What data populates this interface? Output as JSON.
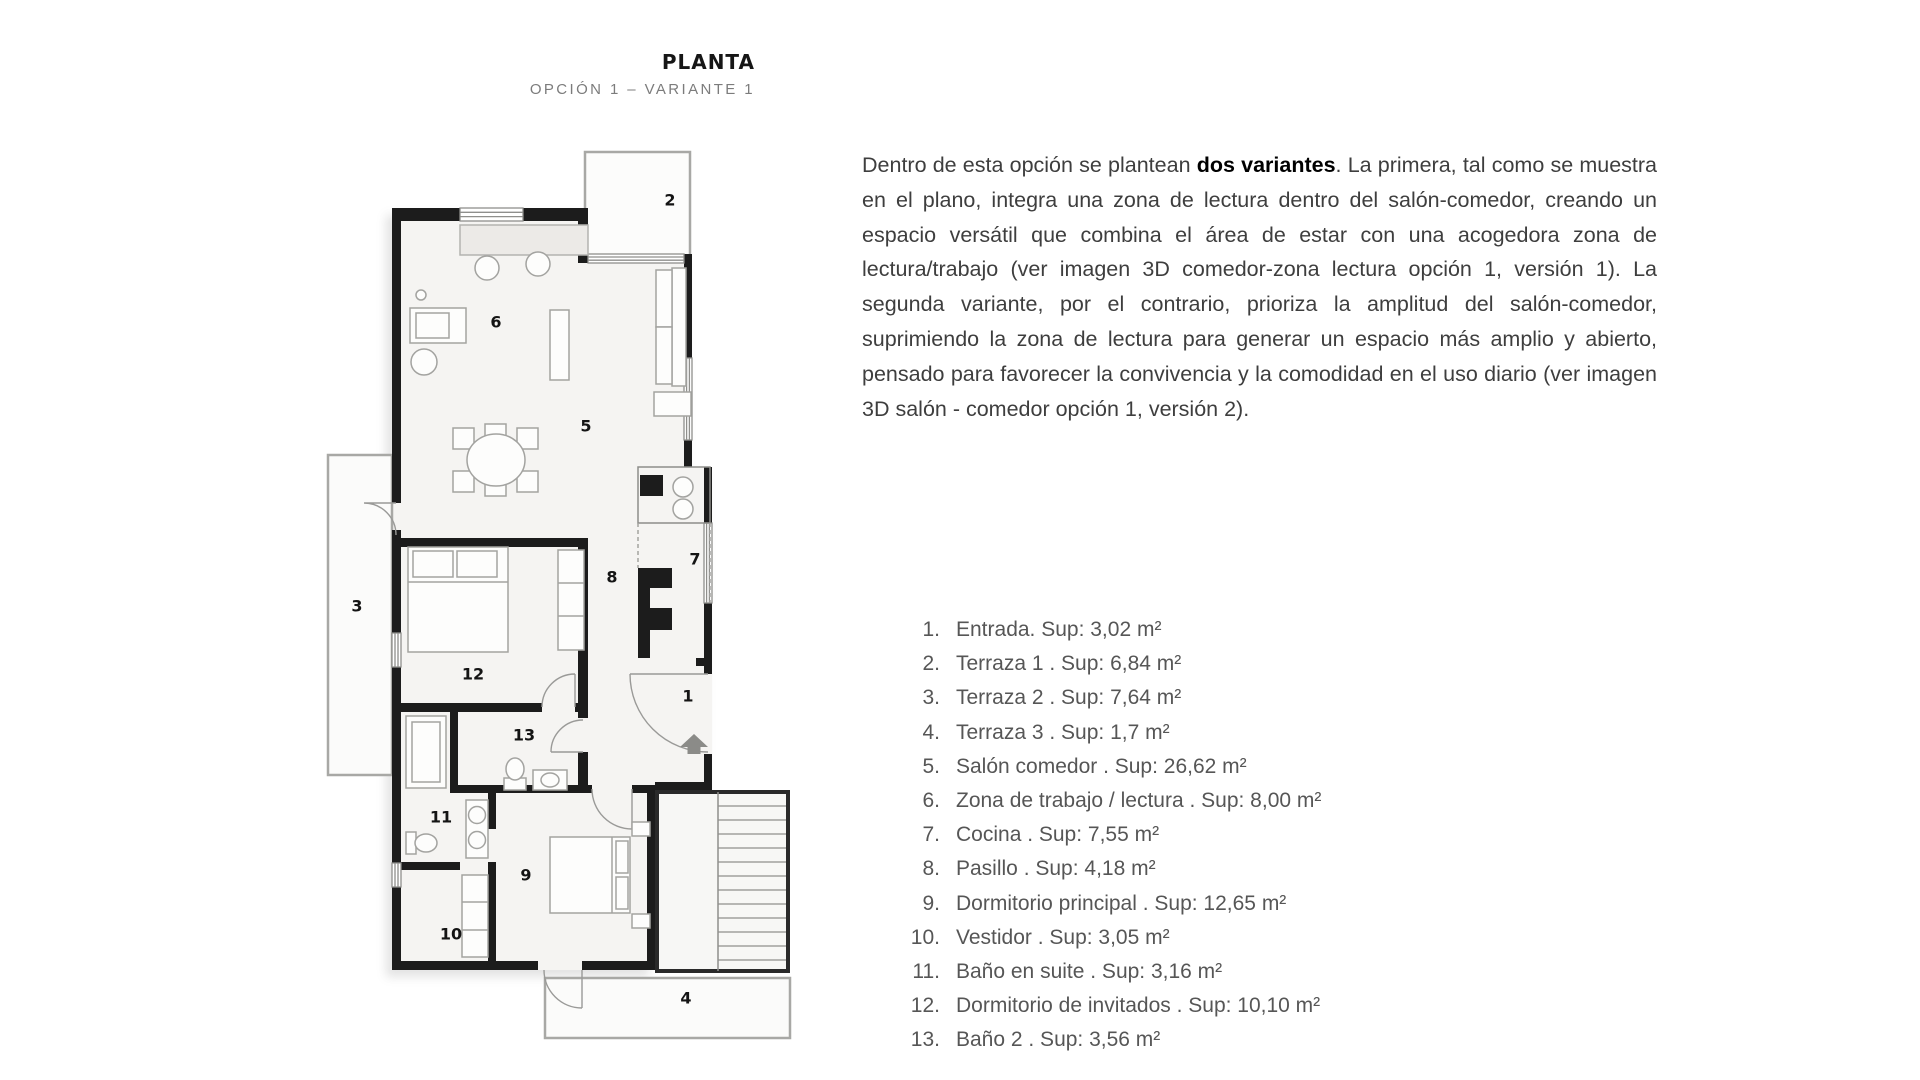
{
  "header": {
    "title": "PLANTA",
    "subtitle": "OPCIÓN 1 – VARIANTE 1"
  },
  "description": {
    "before_bold": "Dentro de esta opción se plantean ",
    "bold": "dos variantes",
    "after_bold": ". La primera, tal como se muestra en el plano, integra una zona de lectura dentro del salón-comedor, creando un espacio versátil que combina el área de estar con una acogedora zona de lectura/trabajo (ver imagen 3D comedor-zona lectura opción 1, versión 1). La segunda variante, por el contrario, prioriza la amplitud del salón-comedor, suprimiendo la zona de lectura para generar un espacio más amplio y abierto, pensado para favorecer la convivencia y la comodidad en el uso diario (ver imagen 3D salón - comedor opción 1, versión 2)."
  },
  "rooms": [
    {
      "num": "1.",
      "text": "Entrada. Sup: 3,02 m²"
    },
    {
      "num": "2.",
      "text": "Terraza 1 . Sup: 6,84 m²"
    },
    {
      "num": "3.",
      "text": "Terraza 2 . Sup: 7,64 m²"
    },
    {
      "num": "4.",
      "text": "Terraza 3 . Sup: 1,7 m²"
    },
    {
      "num": "5.",
      "text": "Salón comedor . Sup: 26,62 m²"
    },
    {
      "num": "6.",
      "text": "Zona de trabajo / lectura . Sup: 8,00 m²"
    },
    {
      "num": "7.",
      "text": "Cocina . Sup: 7,55 m²"
    },
    {
      "num": "8.",
      "text": "Pasillo . Sup: 4,18 m²"
    },
    {
      "num": "9.",
      "text": "Dormitorio principal . Sup: 12,65 m²"
    },
    {
      "num": "10.",
      "text": "Vestidor . Sup: 3,05 m²"
    },
    {
      "num": "11.",
      "text": "Baño en suite . Sup: 3,16 m²"
    },
    {
      "num": "12.",
      "text": "Dormitorio de invitados . Sup: 10,10 m²"
    },
    {
      "num": "13.",
      "text": "Baño 2 . Sup: 3,56 m²"
    }
  ],
  "plan": {
    "labels": [
      {
        "n": "1",
        "x": 368,
        "y": 556
      },
      {
        "n": "2",
        "x": 350,
        "y": 60
      },
      {
        "n": "3",
        "x": 37,
        "y": 466
      },
      {
        "n": "4",
        "x": 366,
        "y": 858
      },
      {
        "n": "5",
        "x": 266,
        "y": 286
      },
      {
        "n": "6",
        "x": 176,
        "y": 182
      },
      {
        "n": "7",
        "x": 375,
        "y": 419
      },
      {
        "n": "8",
        "x": 292,
        "y": 437
      },
      {
        "n": "9",
        "x": 206,
        "y": 735
      },
      {
        "n": "10",
        "x": 131,
        "y": 794
      },
      {
        "n": "11",
        "x": 121,
        "y": 677
      },
      {
        "n": "12",
        "x": 153,
        "y": 534
      },
      {
        "n": "13",
        "x": 204,
        "y": 595
      }
    ]
  },
  "colors": {
    "wall": "#1c1c1c",
    "body_text": "#3e3e3e",
    "muted_text": "#7c7c7c"
  }
}
